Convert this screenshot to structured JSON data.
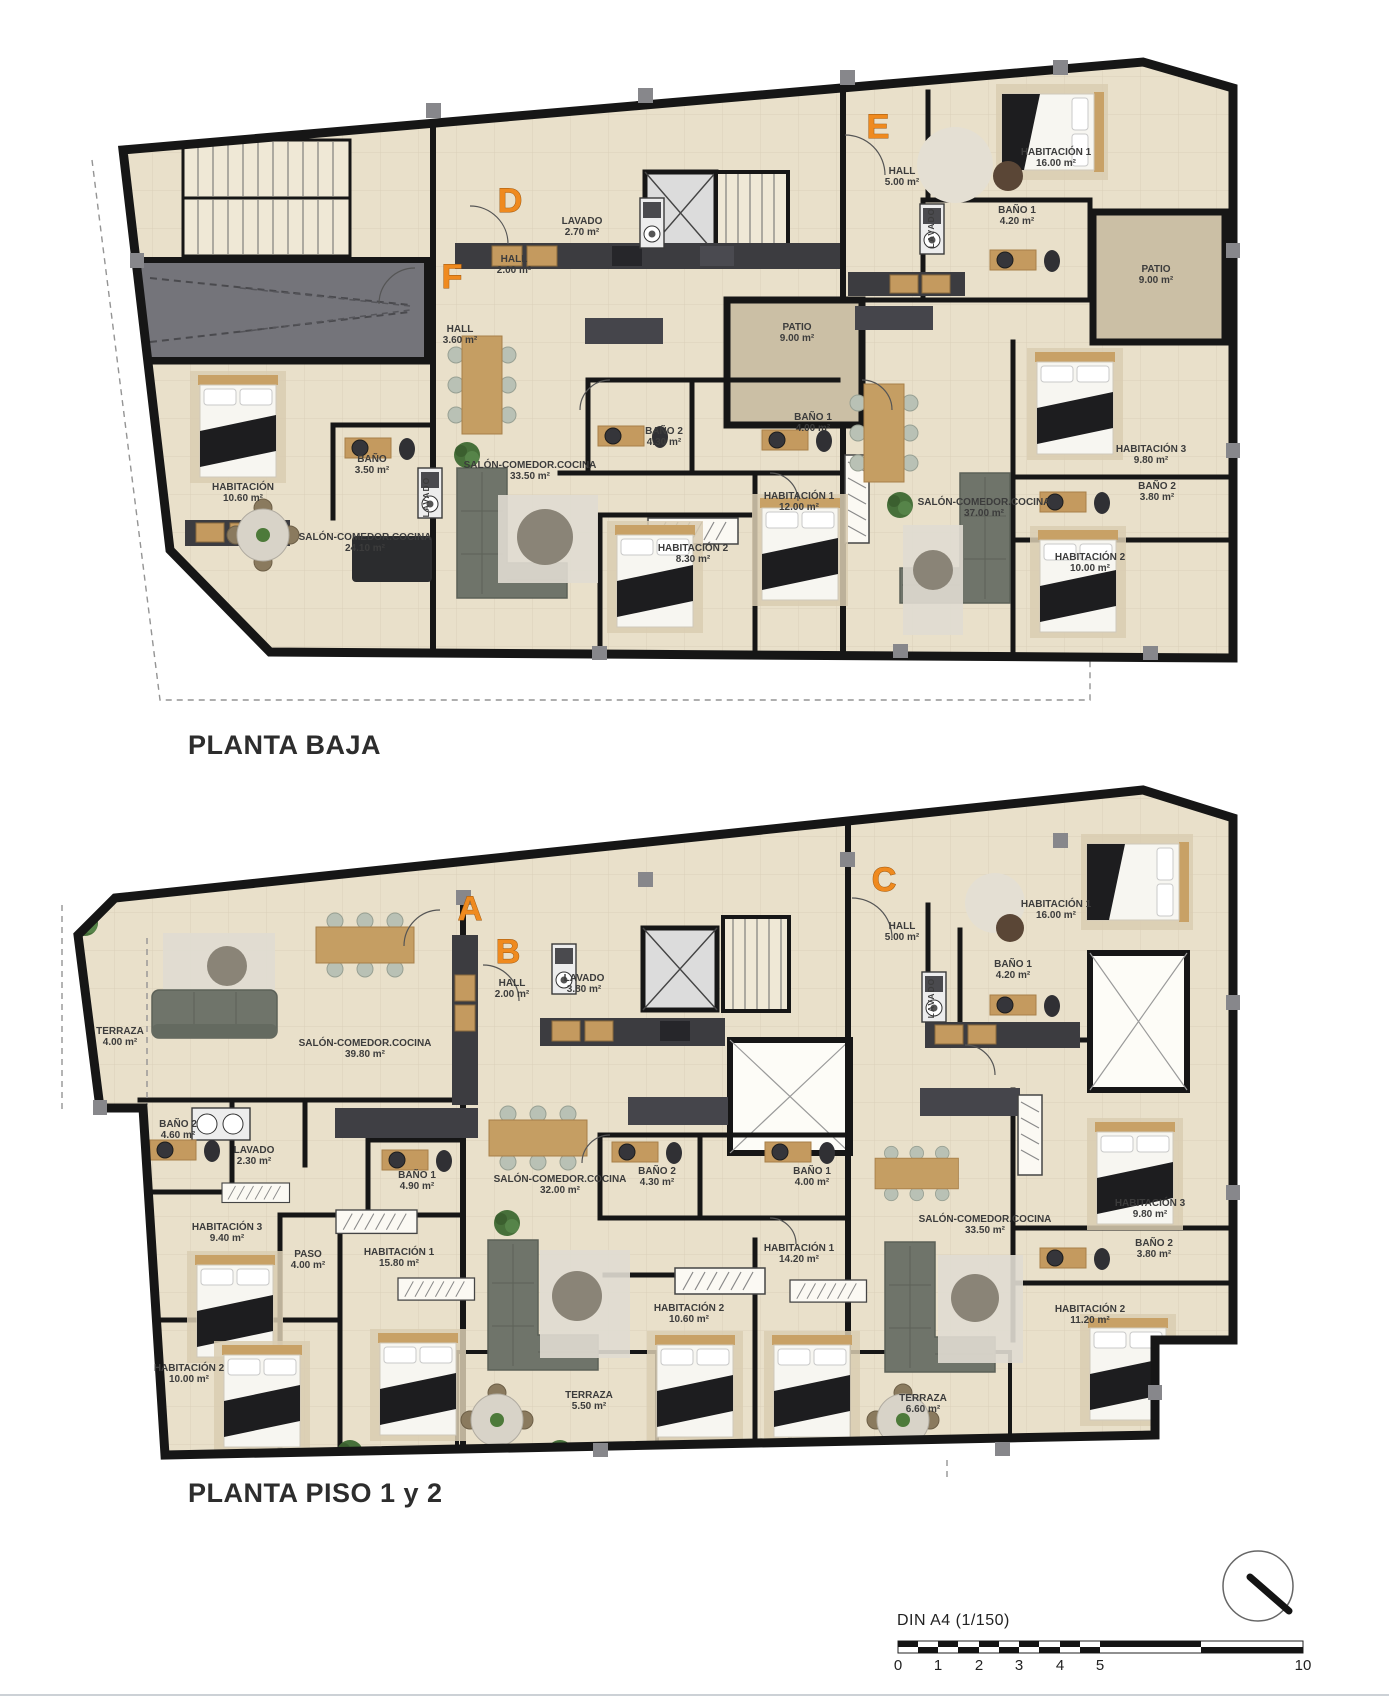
{
  "document": {
    "type_label": "floor-plan-drawing"
  },
  "colors": {
    "accent_orange": "#ef8a1f",
    "wall": "#161616",
    "floor": "#e9e0ca",
    "patio_floor": "#cbbfa5",
    "garage_floor": "#74747a",
    "label_text": "#3c3c3c"
  },
  "plans": [
    {
      "id": "planta-baja",
      "title": "PLANTA BAJA",
      "apartment_letters": [
        {
          "label": "D",
          "x": 510,
          "y": 212
        },
        {
          "label": "F",
          "x": 452,
          "y": 288
        },
        {
          "label": "E",
          "x": 878,
          "y": 138
        }
      ],
      "rooms": [
        {
          "name": "HALL",
          "area": "3.60 m²",
          "x": 460,
          "y": 332
        },
        {
          "name": "HABITACIÓN",
          "area": "10.60 m²",
          "x": 243,
          "y": 490
        },
        {
          "name": "BAÑO",
          "area": "3.50 m²",
          "x": 372,
          "y": 462
        },
        {
          "name": "LAVADO",
          "area": "",
          "x": 429,
          "y": 497,
          "vertical": true
        },
        {
          "name": "SALÓN-COMEDOR.COCINA",
          "area": "24.10 m²",
          "x": 365,
          "y": 540
        },
        {
          "name": "LAVADO",
          "area": "2.70 m²",
          "x": 582,
          "y": 224
        },
        {
          "name": "HALL",
          "area": "2.00 m²",
          "x": 514,
          "y": 262
        },
        {
          "name": "BAÑO 2",
          "area": "4.30 m²",
          "x": 664,
          "y": 434
        },
        {
          "name": "SALÓN-COMEDOR.COCINA",
          "area": "33.50 m²",
          "x": 530,
          "y": 468
        },
        {
          "name": "PATIO",
          "area": "9.00 m²",
          "x": 797,
          "y": 330
        },
        {
          "name": "BAÑO 1",
          "area": "4.00 m²",
          "x": 813,
          "y": 420
        },
        {
          "name": "HABITACIÓN 1",
          "area": "12.00 m²",
          "x": 799,
          "y": 499
        },
        {
          "name": "HABITACIÓN 2",
          "area": "8.30 m²",
          "x": 693,
          "y": 551
        },
        {
          "name": "HALL",
          "area": "5.00 m²",
          "x": 902,
          "y": 174
        },
        {
          "name": "HABITACIÓN 1",
          "area": "16.00 m²",
          "x": 1056,
          "y": 155
        },
        {
          "name": "BAÑO 1",
          "area": "4.20 m²",
          "x": 1017,
          "y": 213
        },
        {
          "name": "LAVADO",
          "area": "",
          "x": 934,
          "y": 228,
          "vertical": true
        },
        {
          "name": "PATIO",
          "area": "9.00 m²",
          "x": 1156,
          "y": 272
        },
        {
          "name": "SALÓN-COMEDOR.COCINA",
          "area": "37.00 m²",
          "x": 984,
          "y": 505
        },
        {
          "name": "HABITACIÓN 3",
          "area": "9.80 m²",
          "x": 1151,
          "y": 452
        },
        {
          "name": "BAÑO 2",
          "area": "3.80 m²",
          "x": 1157,
          "y": 489
        },
        {
          "name": "HABITACIÓN 2",
          "area": "10.00 m²",
          "x": 1090,
          "y": 560
        }
      ]
    },
    {
      "id": "planta-piso-1-2",
      "title": "PLANTA PISO 1 y 2",
      "apartment_letters": [
        {
          "label": "A",
          "x": 470,
          "y": 920
        },
        {
          "label": "B",
          "x": 508,
          "y": 963
        },
        {
          "label": "C",
          "x": 884,
          "y": 891
        }
      ],
      "rooms": [
        {
          "name": "TERRAZA",
          "area": "4.00 m²",
          "x": 120,
          "y": 1034
        },
        {
          "name": "SALÓN-COMEDOR.COCINA",
          "area": "39.80 m²",
          "x": 365,
          "y": 1046
        },
        {
          "name": "HALL",
          "area": "2.00 m²",
          "x": 512,
          "y": 986
        },
        {
          "name": "LAVADO",
          "area": "3.80 m²",
          "x": 584,
          "y": 981
        },
        {
          "name": "HALL",
          "area": "5.00 m²",
          "x": 902,
          "y": 929
        },
        {
          "name": "HABITACIÓN 1",
          "area": "16.00 m²",
          "x": 1056,
          "y": 907
        },
        {
          "name": "BAÑO 1",
          "area": "4.20 m²",
          "x": 1013,
          "y": 967
        },
        {
          "name": "LAVADO",
          "area": "",
          "x": 934,
          "y": 998,
          "vertical": true
        },
        {
          "name": "BAÑO 2",
          "area": "4.60 m²",
          "x": 178,
          "y": 1127
        },
        {
          "name": "LAVADO",
          "area": "2.30 m²",
          "x": 254,
          "y": 1153
        },
        {
          "name": "BAÑO 1",
          "area": "4.90 m²",
          "x": 417,
          "y": 1178
        },
        {
          "name": "HABITACIÓN 3",
          "area": "9.40 m²",
          "x": 227,
          "y": 1230
        },
        {
          "name": "PASO",
          "area": "4.00 m²",
          "x": 308,
          "y": 1257
        },
        {
          "name": "HABITACIÓN 1",
          "area": "15.80 m²",
          "x": 399,
          "y": 1255
        },
        {
          "name": "SALÓN-COMEDOR.COCINA",
          "area": "32.00 m²",
          "x": 560,
          "y": 1182
        },
        {
          "name": "BAÑO 2",
          "area": "4.30 m²",
          "x": 657,
          "y": 1174
        },
        {
          "name": "BAÑO 1",
          "area": "4.00 m²",
          "x": 812,
          "y": 1174
        },
        {
          "name": "HABITACIÓN 1",
          "area": "14.20 m²",
          "x": 799,
          "y": 1251
        },
        {
          "name": "HABITACIÓN 2",
          "area": "10.60 m²",
          "x": 689,
          "y": 1311
        },
        {
          "name": "HABITACIÓN 2",
          "area": "10.00 m²",
          "x": 189,
          "y": 1371
        },
        {
          "name": "TERRAZA",
          "area": "5.50 m²",
          "x": 589,
          "y": 1398
        },
        {
          "name": "SALÓN-COMEDOR.COCINA",
          "area": "33.50 m²",
          "x": 985,
          "y": 1222
        },
        {
          "name": "HABITACIÓN 3",
          "area": "9.80 m²",
          "x": 1150,
          "y": 1206
        },
        {
          "name": "BAÑO 2",
          "area": "3.80 m²",
          "x": 1154,
          "y": 1246
        },
        {
          "name": "HABITACIÓN 2",
          "area": "11.20 m²",
          "x": 1090,
          "y": 1312
        },
        {
          "name": "TERRAZA",
          "area": "6.60 m²",
          "x": 923,
          "y": 1401
        }
      ]
    }
  ],
  "footer": {
    "paper_scale_label": "DIN A4 (1/150)",
    "scale_ticks": [
      {
        "label": "0",
        "x": 898
      },
      {
        "label": "1",
        "x": 938
      },
      {
        "label": "2",
        "x": 979
      },
      {
        "label": "3",
        "x": 1019
      },
      {
        "label": "4",
        "x": 1060
      },
      {
        "label": "5",
        "x": 1100
      },
      {
        "label": "10",
        "x": 1303
      }
    ]
  }
}
